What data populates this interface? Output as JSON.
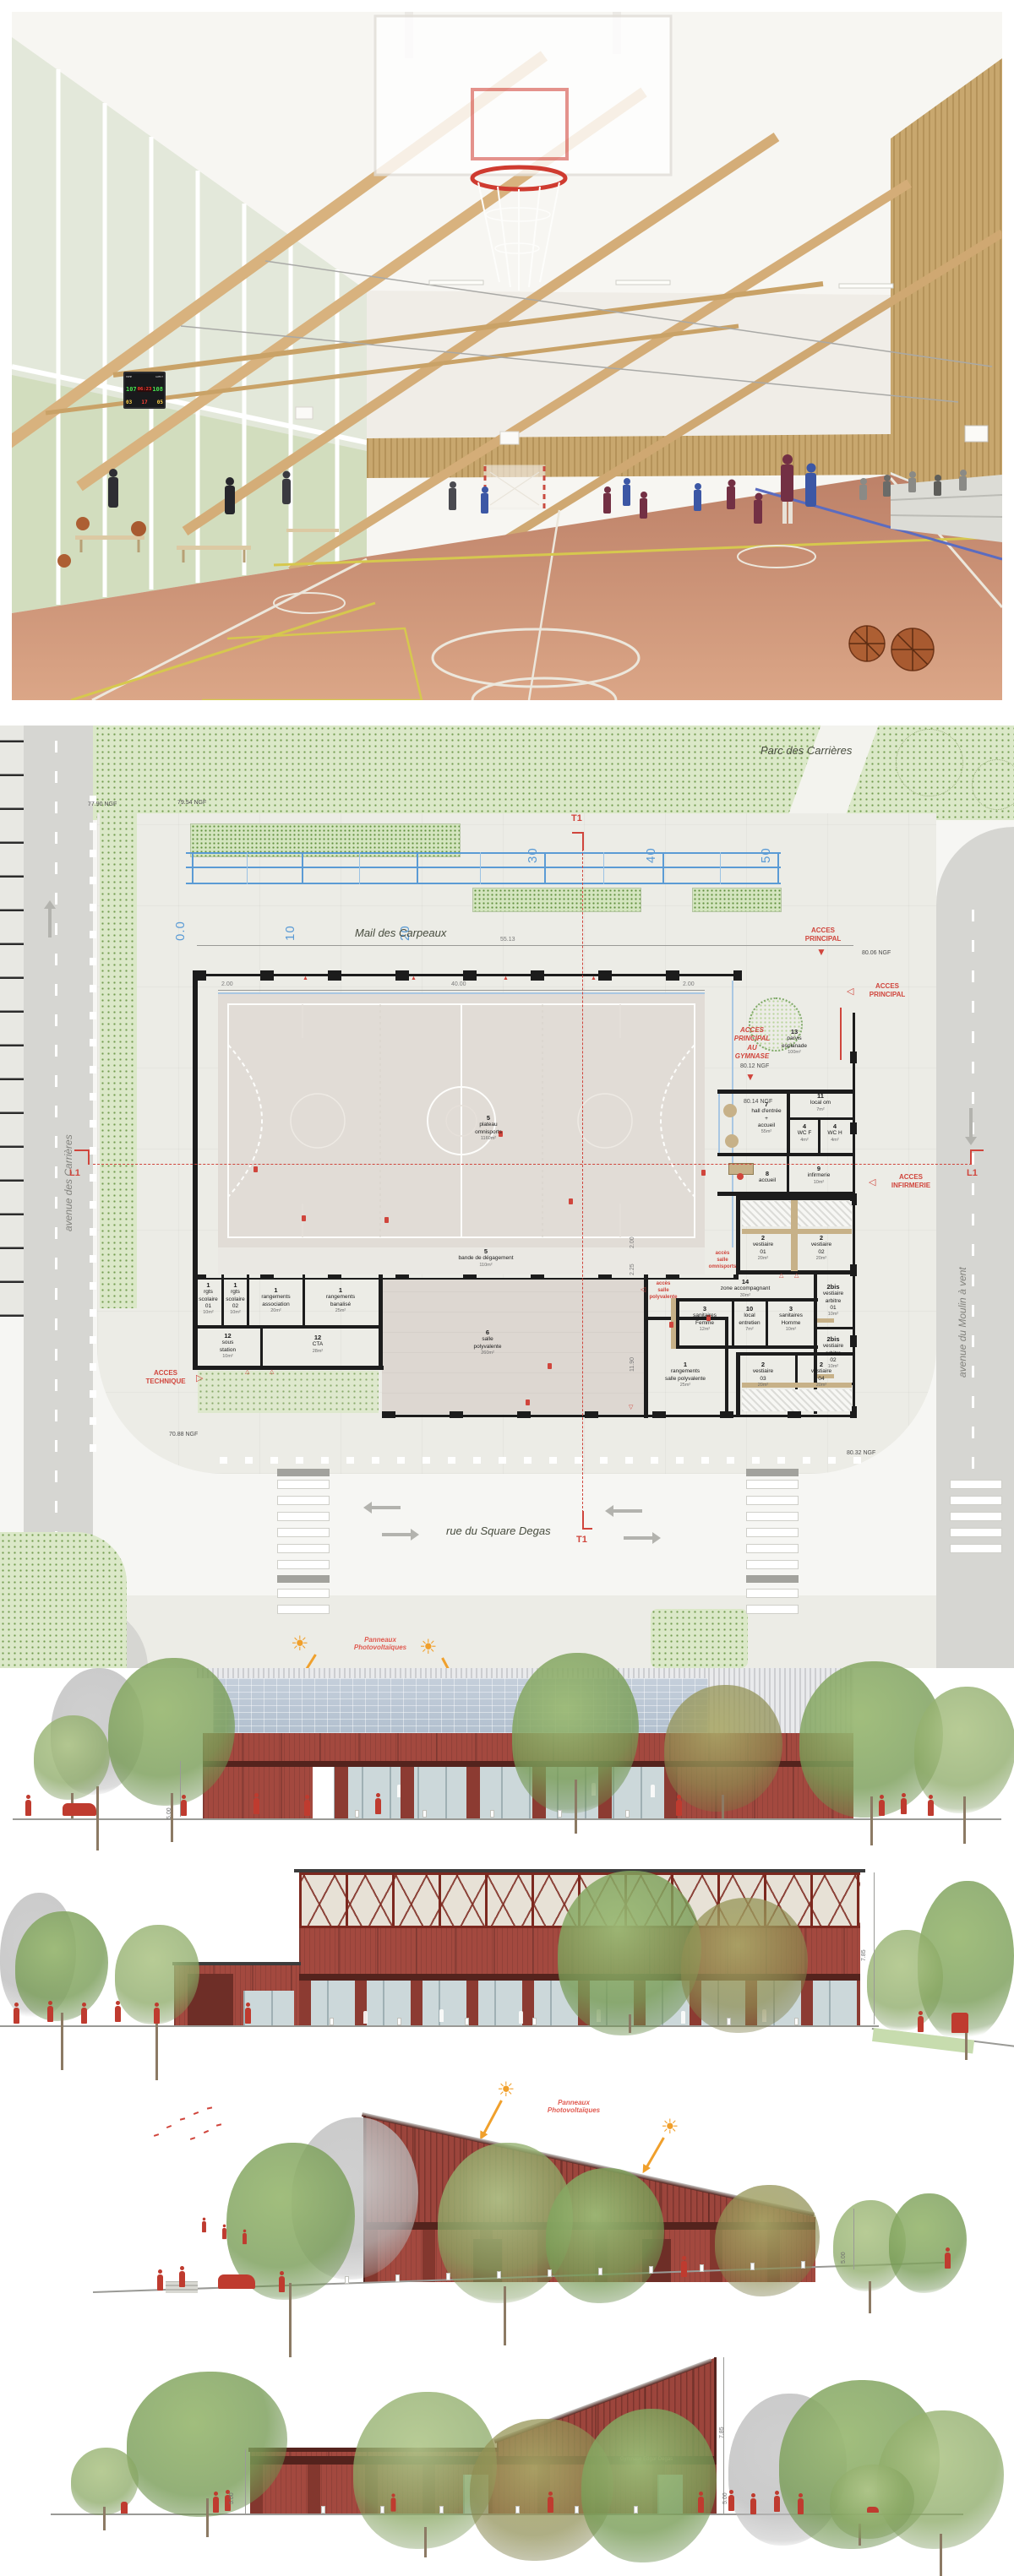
{
  "photo": {
    "scoreboard": {
      "home_label": "HOME",
      "guest_label": "GUEST",
      "home": "107",
      "guest": "108",
      "clock": "06:23",
      "bonus": "03",
      "fouls": "17",
      "period": "05"
    }
  },
  "plan": {
    "area_labels": {
      "parc": "Parc des Carrières",
      "mail": "Mail des Carpeaux",
      "rue": "rue du Square Degas",
      "avenue_left": "avenue des Carrières",
      "avenue_right": "avenue du Moulin à vent"
    },
    "scalebar": {
      "t0": "0.0",
      "t10": "10",
      "t20": "20",
      "t30": "30",
      "t40": "40",
      "t50": "50"
    },
    "markers": {
      "t1": "T1",
      "l1": "L1"
    },
    "levels": {
      "v7790": "77.90 NGF",
      "v7954": "79.54 NGF",
      "v8006": "80.06 NGF",
      "v8014": "80.14 NGF",
      "v7088": "70.88 NGF",
      "v8032": "80.32 NGF"
    },
    "dims": {
      "d5513": "55.13",
      "d4000": "40.00",
      "d200": "2.00",
      "d225": "2.25",
      "d1190": "11.90"
    },
    "access": {
      "principal_top": "ACCES\nPRINCIPAL",
      "principal_right": "ACCES\nPRINCIPAL",
      "gymnase": "ACCES\nPRINCIPAL\nAU\nGYMNASE",
      "gymnase_level": "80.12 NGF",
      "infirmerie": "ACCES\nINFIRMERIE",
      "technique": "ACCES\nTECHNIQUE",
      "salle_omnisports": "accès\nsalle\nomnisports",
      "salle_polyvalente": "accès\nsalle\npolyvalente"
    },
    "rooms": [
      {
        "num": "5",
        "name": "plateau\nomnisports",
        "area": "1160m²"
      },
      {
        "num": "5",
        "name": "bande de dégagement",
        "area": "110m²"
      },
      {
        "num": "6",
        "name": "salle\npolyvalente",
        "area": "260m²"
      },
      {
        "num": "1",
        "name": "rgts\nscolaire\n01",
        "area": "10m²"
      },
      {
        "num": "1",
        "name": "rgts\nscolaire\n02",
        "area": "10m²"
      },
      {
        "num": "1",
        "name": "rangements\nassociation",
        "area": "20m²"
      },
      {
        "num": "1",
        "name": "rangements\nbanalisé",
        "area": "25m²"
      },
      {
        "num": "12",
        "name": "sous\nstation",
        "area": "10m²"
      },
      {
        "num": "12",
        "name": "CTA",
        "area": "28m²"
      },
      {
        "num": "1",
        "name": "rangements\nsalle polyvalente",
        "area": "25m²"
      },
      {
        "num": "14",
        "name": "zone accompagnant",
        "area": "30m²"
      },
      {
        "num": "3",
        "name": "sanitaires\nFemme",
        "area": "12m²"
      },
      {
        "num": "10",
        "name": "local\nentretien",
        "area": "7m²"
      },
      {
        "num": "3",
        "name": "sanitaires\nHomme",
        "area": "10m²"
      },
      {
        "num": "2",
        "name": "vestiaire\n01",
        "area": "20m²"
      },
      {
        "num": "2",
        "name": "vestiaire\n02",
        "area": "20m²"
      },
      {
        "num": "2bis",
        "name": "vestiaire\narbitre\n01",
        "area": "10m²"
      },
      {
        "num": "2bis",
        "name": "vestiaire\narbitre\n02",
        "area": "10m²"
      },
      {
        "num": "2",
        "name": "vestiaire\n03",
        "area": "20m²"
      },
      {
        "num": "2",
        "name": "vestiaire\n04",
        "area": "20m²"
      },
      {
        "num": "7",
        "name": "hall d'entrée\n+\naccueil",
        "area": "55m²"
      },
      {
        "num": "8",
        "name": "accueil"
      },
      {
        "num": "9",
        "name": "infirmerie",
        "area": "10m²"
      },
      {
        "num": "11",
        "name": "local om",
        "area": "7m²"
      },
      {
        "num": "4",
        "name": "WC F",
        "area": "4m²"
      },
      {
        "num": "4",
        "name": "WC H",
        "area": "4m²"
      },
      {
        "num": "13",
        "name": "parvis\nesplanade",
        "area": "100m²"
      }
    ]
  },
  "elevations": {
    "pv": "Panneaux\nPhotovoltaïques",
    "facade_name": "Gymnase Edgar Degas",
    "d500": "5.00",
    "d785": "7.85"
  },
  "colors": {
    "facade_red": "#a3493f",
    "dark_band": "#54231d",
    "accent_red": "#d0453c",
    "scale_blue": "#5b9bd5",
    "pv_panel": "#b9c6d6",
    "sun_orange": "#f0a02c"
  }
}
